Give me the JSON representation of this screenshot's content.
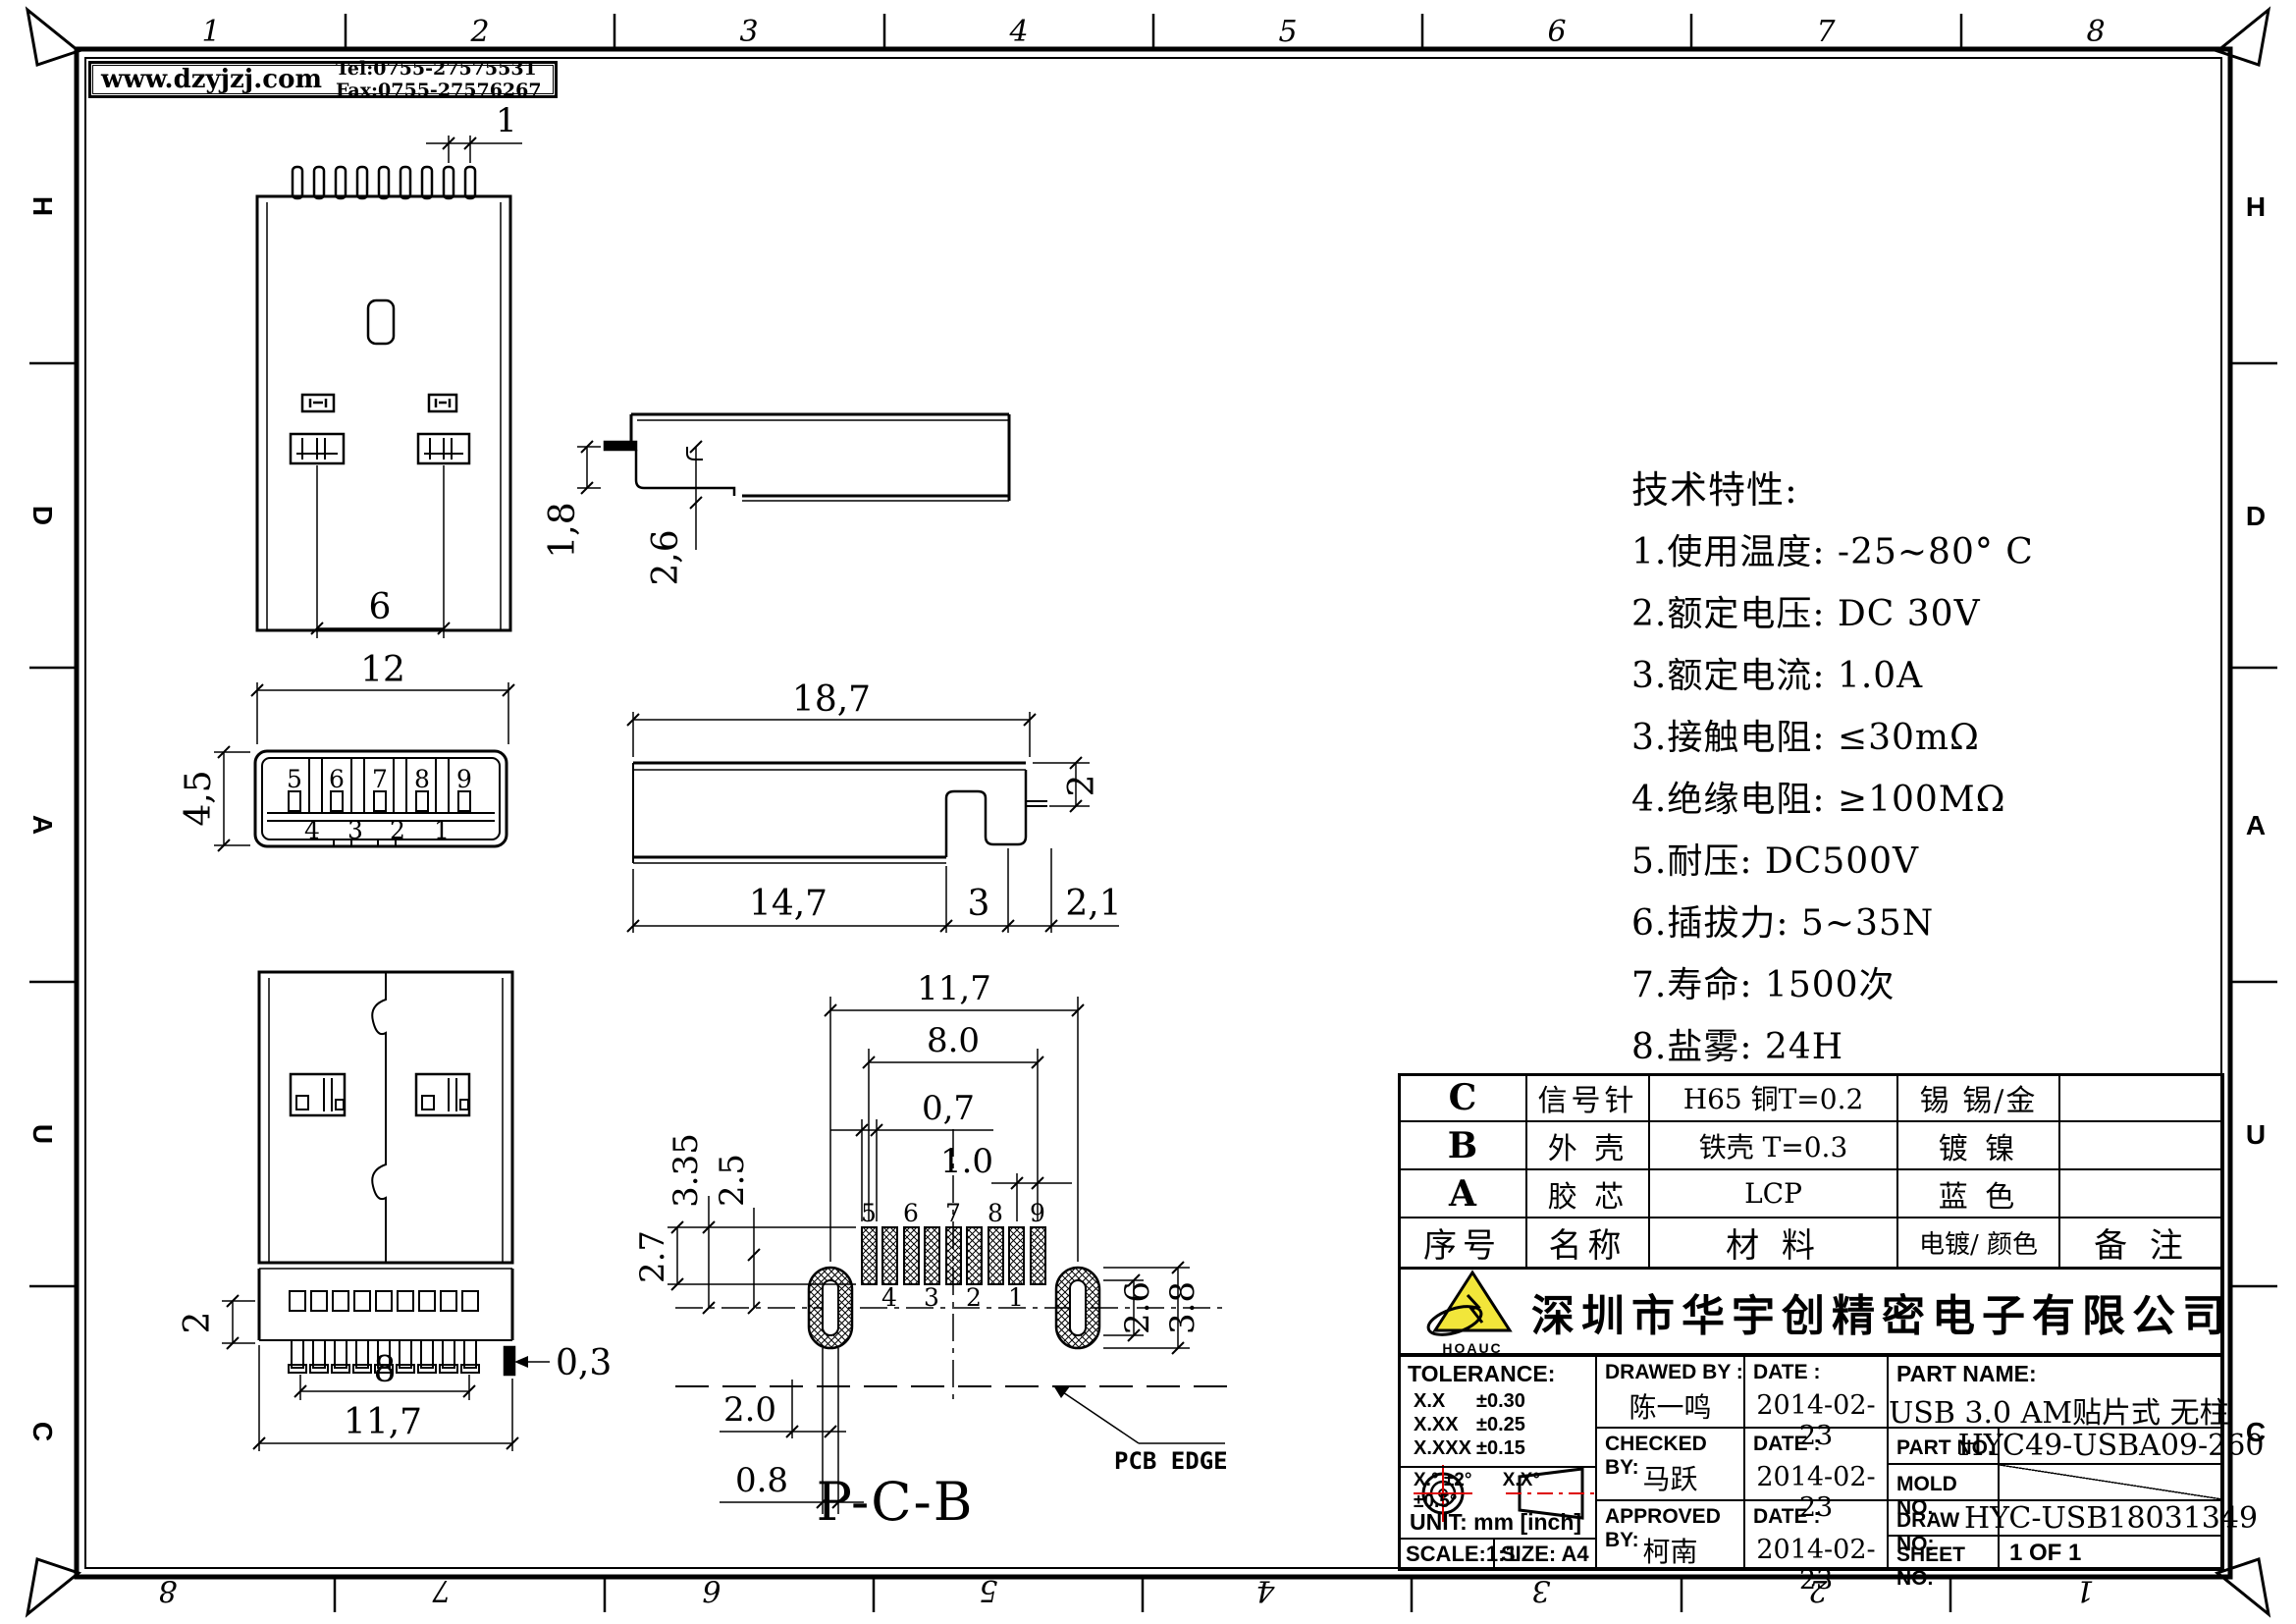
{
  "header": {
    "site": "www.dzyjzj.com",
    "contact": "Tel:0755-27575531  Fax:0755-27576267"
  },
  "border": {
    "top_numbers": [
      "1",
      "2",
      "3",
      "4",
      "5",
      "6",
      "7",
      "8"
    ],
    "bottom_numbers": [
      "8",
      "7",
      "6",
      "5",
      "4",
      "3",
      "2",
      "1"
    ],
    "left_letters": [
      "H",
      "D",
      "A",
      "U",
      "C"
    ],
    "right_letters": [
      "H",
      "D",
      "A",
      "U",
      "C"
    ]
  },
  "specs": {
    "title": "技术特性:",
    "items": [
      "1.使用温度: -25~80° C",
      "2.额定电压: DC 30V",
      "3.额定电流:  1.0A",
      "3.接触电阻: ≤30mΩ",
      "4.绝缘电阻: ≥100MΩ",
      "5.耐压: DC500V",
      "6.插拔力: 5~35N",
      "7.寿命: 1500次",
      "8.盐雾: 24H"
    ]
  },
  "views": {
    "top": {
      "pin_pitch": "1",
      "latch_span": "6"
    },
    "front": {
      "width": "12",
      "height": "4,5",
      "pins_top": [
        "5",
        "6",
        "7",
        "8",
        "9"
      ],
      "pins_bottom": [
        "4",
        "3",
        "2",
        "1"
      ]
    },
    "side_upper": {
      "h1": "1,8",
      "h2": "2,6"
    },
    "side_lower": {
      "length": "18,7",
      "tab": "2",
      "b1": "14,7",
      "b2": "3",
      "b3": "2,1"
    },
    "back": {
      "h": "2",
      "pin_span": "8",
      "width": "11,7",
      "tail": "0,3"
    },
    "pcb": {
      "title": "P-C-B",
      "edge_label": "PCB EDGE",
      "w": "11,7",
      "span": "8.0",
      "pad_w": "0,7",
      "pitch": "1.0",
      "left1": "3.35",
      "left2": "2.5",
      "left3": "2.7",
      "bottom1": "2.0",
      "bottom2": "0.8",
      "right1": "2.6",
      "right2": "3.8",
      "pads_top": [
        "5",
        "6",
        "7",
        "8",
        "9"
      ],
      "pads_bottom": [
        "4",
        "3",
        "2",
        "1"
      ]
    }
  },
  "materials": {
    "rows": [
      {
        "seq": "C",
        "name": "信号针",
        "material": "H65 铜T=0.2",
        "plating": "锡  锡/金",
        "note": ""
      },
      {
        "seq": "B",
        "name": "外 壳",
        "material": "铁壳 T=0.3",
        "plating": "镀  镍",
        "note": ""
      },
      {
        "seq": "A",
        "name": "胶 芯",
        "material": "LCP",
        "plating": "蓝  色",
        "note": ""
      }
    ],
    "header": {
      "seq": "序号",
      "name": "名称",
      "material": "材  料",
      "plating": "电镀/ 颜色",
      "note": "备  注"
    }
  },
  "title_block": {
    "company": "深圳市华宇创精密电子有限公司",
    "logo_text": "HOAUC",
    "tolerance": {
      "title": "TOLERANCE:",
      "rows": [
        {
          "k": "X.X",
          "v": "±0.30"
        },
        {
          "k": "X.XX",
          "v": "±0.25"
        },
        {
          "k": "X.XXX",
          "v": "±0.15"
        }
      ],
      "angle_left": "X.°  ±2°",
      "angle_right": "X.X°  ±0.5°"
    },
    "unit": "UNIT:  mm  [inch]",
    "scale": "SCALE:1:1",
    "size": "SIZE:  A4",
    "drawed": {
      "label": "DRAWED BY :",
      "name": "陈一鸣",
      "date_label": "DATE :",
      "date": "2014-02-23"
    },
    "checked": {
      "label": "CHECKED BY:",
      "name": "马跃",
      "date_label": "DATE :",
      "date": "2014-02-23"
    },
    "approved": {
      "label": "APPROVED BY:",
      "name": "柯南",
      "date_label": "DATE :",
      "date": "2014-02-23"
    },
    "part_name": {
      "label": "PART NAME:",
      "value": "USB 3.0 AM贴片式 无柱"
    },
    "part_no": {
      "label": "PART NO.",
      "value": "HYC49-USBA09-260"
    },
    "mold_no": {
      "label": "MOLD NO.",
      "value": ""
    },
    "draw_no": {
      "label": "DRAW NO:",
      "value": "HYC-USB18031349"
    },
    "sheet_no": {
      "label": "SHEET NO.",
      "value": "1 OF 1"
    }
  },
  "colors": {
    "line": "#000000",
    "accent_red": "#dd0000",
    "logo_yellow": "#f2e63a"
  }
}
